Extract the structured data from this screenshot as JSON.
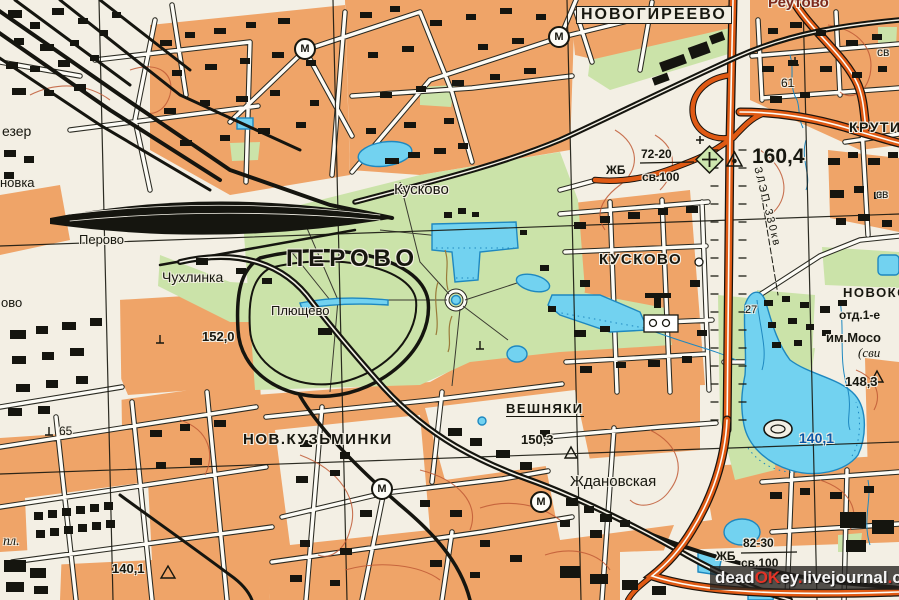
{
  "meta": {
    "description": "Scanned Soviet topographic map sheet, eastern Moscow: Perovo, Kuskovo, Veshnyaki, Novogireevo districts"
  },
  "colors": {
    "paper": "#F3EFE4",
    "urban_block_orange": "#EFA468",
    "park_green": "#CBE3A9",
    "water_fill": "#72D2F0",
    "water_line": "#1E88C0",
    "ink_black": "#17170f",
    "highway_orange": "#E05A14",
    "contour_red": "#C05A36",
    "red_place_label": "#7E2A1C",
    "lake_label_blue": "#0a57a8",
    "watermark_red": "#e23326",
    "watermark_white": "#f5f5f5"
  },
  "labels": [
    {
      "id": "novogireevo",
      "text": "НОВОГИРЕЕВО",
      "x": 576,
      "y": 6,
      "fs": 16,
      "cls": "caps boxed"
    },
    {
      "id": "reutovo",
      "text": "Реутово",
      "x": 768,
      "y": -5,
      "fs": 15,
      "cls": "red-label"
    },
    {
      "id": "krutitsy",
      "text": "КРУТИЦ",
      "x": 849,
      "y": 120,
      "fs": 14,
      "cls": "caps"
    },
    {
      "id": "elev-160-4",
      "text": "160,4",
      "x": 752,
      "y": 146,
      "fs": 21,
      "cls": "elev"
    },
    {
      "id": "bridge1-top",
      "text": "72-20",
      "x": 641,
      "y": 148,
      "fs": 12,
      "cls": "elev"
    },
    {
      "id": "bridge1-mat",
      "text": "ЖБ",
      "x": 606,
      "y": 164,
      "fs": 12,
      "cls": "elev"
    },
    {
      "id": "bridge1-load",
      "text": "св.100",
      "x": 642,
      "y": 171,
      "fs": 12,
      "cls": "elev"
    },
    {
      "id": "perovo-district",
      "text": "ПЕРОВО",
      "x": 286,
      "y": 247,
      "fs": 24,
      "cls": "spaced"
    },
    {
      "id": "kuskovo-park",
      "text": "Кусково",
      "x": 394,
      "y": 182,
      "fs": 15
    },
    {
      "id": "kuskovo-district",
      "text": "КУСКОВО",
      "x": 599,
      "y": 252,
      "fs": 15,
      "cls": "caps"
    },
    {
      "id": "perovo-station",
      "text": "Перово",
      "x": 79,
      "y": 233,
      "fs": 13
    },
    {
      "id": "chukhlinka",
      "text": "Чухлинка",
      "x": 162,
      "y": 270,
      "fs": 14
    },
    {
      "id": "plyushchevo",
      "text": "Плющево",
      "x": 271,
      "y": 304,
      "fs": 13
    },
    {
      "id": "elev-152-0",
      "text": "152,0",
      "x": 202,
      "y": 330,
      "fs": 13,
      "cls": "elev"
    },
    {
      "id": "veshnyaki",
      "text": "ВЕШНЯКИ",
      "x": 506,
      "y": 402,
      "fs": 13,
      "cls": "caps underline"
    },
    {
      "id": "elev-150-3",
      "text": "150,3",
      "x": 521,
      "y": 433,
      "fs": 13,
      "cls": "elev"
    },
    {
      "id": "nov-kuzminki",
      "text": "НОВ.КУЗЬМИНКИ",
      "x": 243,
      "y": 432,
      "fs": 15,
      "cls": "caps"
    },
    {
      "id": "zhdanovskaya",
      "text": "Ждановская",
      "x": 570,
      "y": 474,
      "fs": 15
    },
    {
      "id": "elev-140-1-sw",
      "text": "140,1",
      "x": 112,
      "y": 562,
      "fs": 13,
      "cls": "elev"
    },
    {
      "id": "num-65",
      "text": "65",
      "x": 59,
      "y": 425,
      "fs": 12
    },
    {
      "id": "num-61",
      "text": "61",
      "x": 781,
      "y": 77,
      "fs": 12
    },
    {
      "id": "num-27",
      "text": "27",
      "x": 745,
      "y": 305,
      "fs": 11
    },
    {
      "id": "novokosino",
      "text": "НОВОКОС",
      "x": 843,
      "y": 286,
      "fs": 13,
      "cls": "caps"
    },
    {
      "id": "otd-1e",
      "text": "отд.1-е",
      "x": 839,
      "y": 309,
      "fs": 12,
      "cls": "elev"
    },
    {
      "id": "im-moso",
      "text": "им.Мосо",
      "x": 826,
      "y": 331,
      "fs": 13,
      "cls": "elev"
    },
    {
      "id": "svi",
      "text": "(сви",
      "x": 858,
      "y": 346,
      "fs": 13,
      "cls": "italic"
    },
    {
      "id": "elev-148-3",
      "text": "148,3",
      "x": 845,
      "y": 375,
      "fs": 13,
      "cls": "elev"
    },
    {
      "id": "lake-140-1",
      "text": "140,1",
      "x": 799,
      "y": 431,
      "fs": 14,
      "cls": "lake-label"
    },
    {
      "id": "bridge2-top",
      "text": "82-30",
      "x": 743,
      "y": 537,
      "fs": 12,
      "cls": "elev"
    },
    {
      "id": "bridge2-mat",
      "text": "ЖБ",
      "x": 716,
      "y": 550,
      "fs": 12,
      "cls": "elev"
    },
    {
      "id": "bridge2-load",
      "text": "св.100",
      "x": 741,
      "y": 557,
      "fs": 12,
      "cls": "elev"
    },
    {
      "id": "ezer",
      "text": "езер",
      "x": 2,
      "y": 124,
      "fs": 14
    },
    {
      "id": "novka",
      "text": "новка",
      "x": 0,
      "y": 176,
      "fs": 13
    },
    {
      "id": "ovo",
      "text": "ово",
      "x": 1,
      "y": 296,
      "fs": 13
    },
    {
      "id": "pl",
      "text": "пл.",
      "x": 3,
      "y": 535,
      "fs": 14,
      "cls": "italic"
    },
    {
      "id": "sv-right",
      "text": "св",
      "x": 876,
      "y": 188,
      "fs": 12
    },
    {
      "id": "sv-top",
      "text": "св",
      "x": 877,
      "y": 46,
      "fs": 12
    },
    {
      "id": "lep-line",
      "text": "ЗЛЭП-330кв",
      "x": 762,
      "y": 166,
      "fs": 11,
      "cls": "rot"
    }
  ],
  "metro_letter": "М",
  "metro_stations": [
    {
      "id": "metro-1",
      "x": 305,
      "y": 49
    },
    {
      "id": "metro-2",
      "x": 559,
      "y": 37
    },
    {
      "id": "metro-3",
      "x": 382,
      "y": 489
    },
    {
      "id": "metro-4",
      "x": 541,
      "y": 502
    }
  ],
  "watermark": {
    "segments": [
      {
        "text": "dead",
        "color": "#f5f5f5"
      },
      {
        "text": "OK",
        "color": "#e23326"
      },
      {
        "text": "ey",
        "color": "#f5f5f5"
      },
      {
        "text": ".",
        "color": "#e23326"
      },
      {
        "text": "livejournal",
        "color": "#f5f5f5"
      },
      {
        "text": ".",
        "color": "#e23326"
      },
      {
        "text": "com",
        "color": "#f5f5f5"
      }
    ]
  }
}
